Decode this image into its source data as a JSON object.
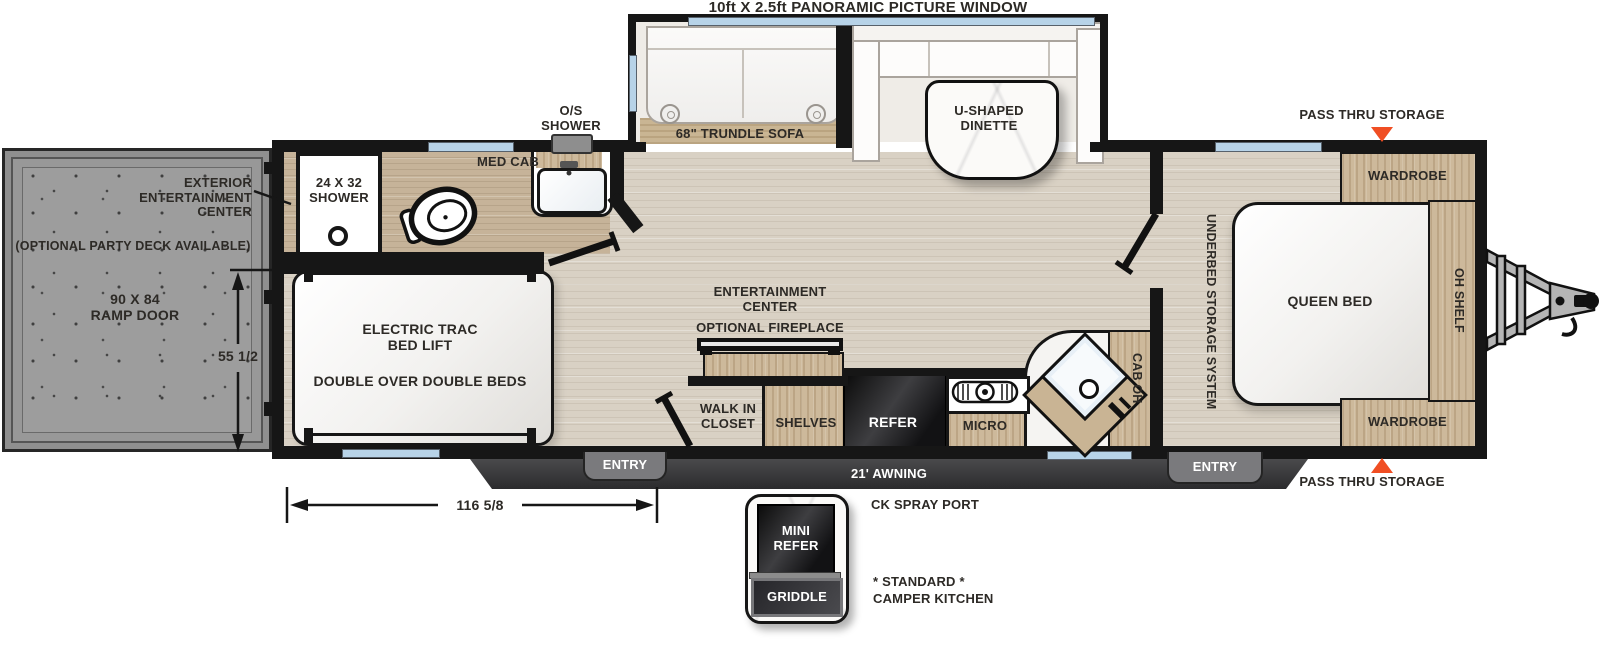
{
  "title": "10ft X 2.5ft PANORAMIC PICTURE WINDOW",
  "slideout": {
    "sofa": "68\" TRUNDLE SOFA",
    "dinette": "U-SHAPED\nDINETTE"
  },
  "ramp": {
    "exterior_entertainment": "EXTERIOR\nENTERTAINMENT\nCENTER",
    "party_deck": "(OPTIONAL PARTY DECK AVAILABLE)",
    "ramp_door": "90 X 84\nRAMP DOOR",
    "height_dim": "55 1/2"
  },
  "bathroom": {
    "shower": "24 X 32\nSHOWER",
    "med_cab": "MED CAB",
    "os_shower": "O/S\nSHOWER"
  },
  "garage": {
    "bed_lift": "ELECTRIC TRAC\nBED LIFT",
    "beds": "DOUBLE OVER DOUBLE BEDS"
  },
  "kitchen": {
    "entertainment": "ENTERTAINMENT\nCENTER",
    "fireplace": "OPTIONAL FIREPLACE",
    "closet": "WALK IN\nCLOSET",
    "shelves": "SHELVES",
    "refer": "REFER",
    "micro": "MICRO",
    "cab_oh": "CAB OH"
  },
  "bedroom": {
    "underbed": "UNDERBED STORAGE SYSTEM",
    "queen_bed": "QUEEN BED",
    "wardrobe_top": "WARDROBE",
    "wardrobe_bottom": "WARDROBE",
    "oh_shelf": "OH SHELF"
  },
  "storage": {
    "pass_thru_top": "PASS THRU STORAGE",
    "pass_thru_bottom": "PASS THRU STORAGE"
  },
  "exterior": {
    "entry_left": "ENTRY",
    "entry_right": "ENTRY",
    "awning": "21' AWNING",
    "spray_port": "CK SPRAY PORT",
    "length_dim": "116 5/8"
  },
  "camper_kitchen": {
    "mini_refer": "MINI\nREFER",
    "griddle": "GRIDDLE",
    "note": "* STANDARD *\nCAMPER KITCHEN"
  },
  "colors": {
    "accent_orange": "#F04E23",
    "wall_black": "#161616",
    "window_blue": "#B7D3E8",
    "wood_tan": "#CDB99B",
    "floor_light": "#D9D1C4",
    "floor_bath": "#C6B399",
    "awning_gray": "#3A3A3C"
  }
}
